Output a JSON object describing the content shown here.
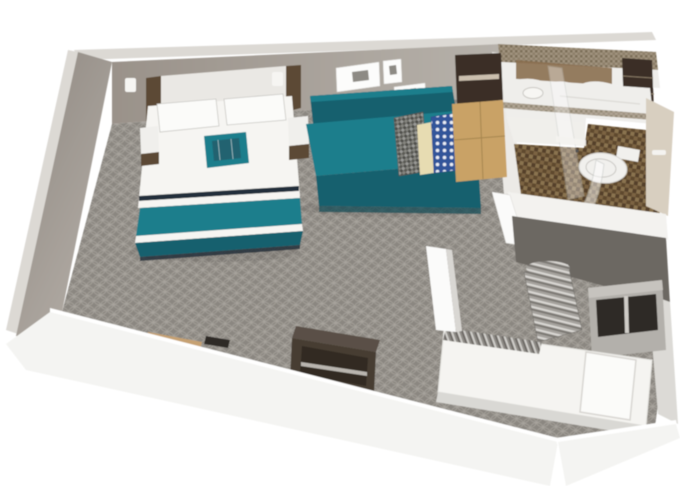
{
  "meta": {
    "title": "3D isometric cutaway rendering of a hotel suite floor plan",
    "view": "aerial-cutaway-render"
  },
  "palette": {
    "bg": "#ffffff",
    "wall_top_edge": "#dcd9d4",
    "wall_left_dark": "#8f8881",
    "wall_left_light": "#b3ada6",
    "wall_back_dark": "#9a928a",
    "wall_back_light": "#b7b2ab",
    "wood_trim": "#5c4836",
    "headboard_panel": "#eae8e4",
    "sconce": "#f6f5f2",
    "frame_white": "#fcfcfb",
    "frame_art": "#8d8a84",
    "carpet_base": "#8b8781",
    "carpet_line": "#a7a39c",
    "navy": "#232f3a",
    "teal": "#1f7e8c",
    "teal_dark": "#14606e",
    "teal_darker": "#0e4a56",
    "bed_white": "#f6f5f2",
    "bed_shadow": "#d9d8d4",
    "pillow_white": "#fbfbf9",
    "pillow_edge": "#c9c8c4",
    "plaid_base": "#85857f",
    "plaid_dark": "#4f4f4b",
    "plaid_mid": "#9a9a96",
    "cream": "#e7dcb2",
    "blue_pillow": "#33549a",
    "blue_dot": "#e9edf5",
    "console_dark": "#3a2f25",
    "console_tan": "#c9a266",
    "console_tan_line": "#a5854f",
    "cab_shelf_line": "#8a7a66",
    "bath_tile_band": "#a0937e",
    "bath_tile_dark": "#7c6e58",
    "bath_white": "#efeeeb",
    "bath_wall_light": "#eceae6",
    "marble": "#8a6e4f",
    "mosaic_a": "#7c6443",
    "mosaic_b": "#5f4a2e",
    "mosaic_c": "#55412a",
    "mosaic_d": "#8a7350",
    "sink_stroke": "#c9c7c2",
    "tub_line": "#dcdad6",
    "towel_white": "#f4f3f0",
    "glass_stroke": "#c2c6c4",
    "toilet_white": "#f1f0ed",
    "beige_wall": "#d8cfc0",
    "partition_white": "#f3f2ef",
    "door_wall_white": "#fbfbfa",
    "dark_wall": "#6c6862",
    "right_wall_band": "#dcdad6",
    "shelf_frame": "#b3b0ab",
    "shelf_top": "#c6c3be",
    "shelf_dark": "#2f2b27",
    "shelf_divider": "#cfccc7",
    "curtain_a": "#d9d7d3",
    "curtain_b": "#7b7873",
    "curtain_c": "#a5a29d",
    "twin_bed_white": "#f5f4f1",
    "blanket_a": "#cfcdc9",
    "blanket_b": "#6e6b66",
    "blanket_c": "#8f8c87",
    "dresser": "#463c33",
    "dresser_open": "#332b24",
    "dresser_shelf": "#b9b5af",
    "desk_dark": "#42382f",
    "desk_front": "#332b23",
    "desk_grain": "#6b5d4e",
    "chair_tan": "#c6a172",
    "chair_tan_dark": "#bb9361",
    "laptop": "#2d2a26",
    "ledge_tan": "#c7a26b",
    "ledge_front": "#a8854f",
    "front_wall": "#f4f4f2",
    "front_top": "#ffffff",
    "nightstand_top": "#f0efec",
    "shadow_color": "#000000"
  },
  "scene": {
    "rooms": [
      {
        "name": "bedroom-living-area",
        "items": [
          "king-bed-teal-runner",
          "white-pillows",
          "teal-throw-pillow",
          "nightstands",
          "wall-sconces",
          "headboard-panel",
          "wood-trim",
          "wall-art-frames",
          "teal-sofa-daybed",
          "plaid-pillow",
          "cream-pillow",
          "blue-dot-pillow",
          "tv-console-hutch",
          "tan-cabinet",
          "work-desk",
          "tan-chair",
          "laptop",
          "wood-ledge",
          "dark-dresser"
        ]
      },
      {
        "name": "bathroom",
        "items": [
          "mosaic-tile-band",
          "marble-backsplash",
          "vanity-sink",
          "bathtub",
          "glass-shower-panel",
          "glass-shower-door",
          "towel-bar",
          "toilet",
          "dark-storage-cabinet",
          "beige-wall",
          "brown-mosaic-floor",
          "entry-tile"
        ]
      },
      {
        "name": "second-bedroom",
        "items": [
          "twin-bed",
          "white-pillow",
          "striped-blanket",
          "privacy-curtain",
          "cubby-shelf-unit",
          "dark-back-wall"
        ]
      }
    ],
    "floor": {
      "main": "gray-quatrefoil-carpet",
      "bathroom": "brown-mosaic-tile"
    }
  }
}
